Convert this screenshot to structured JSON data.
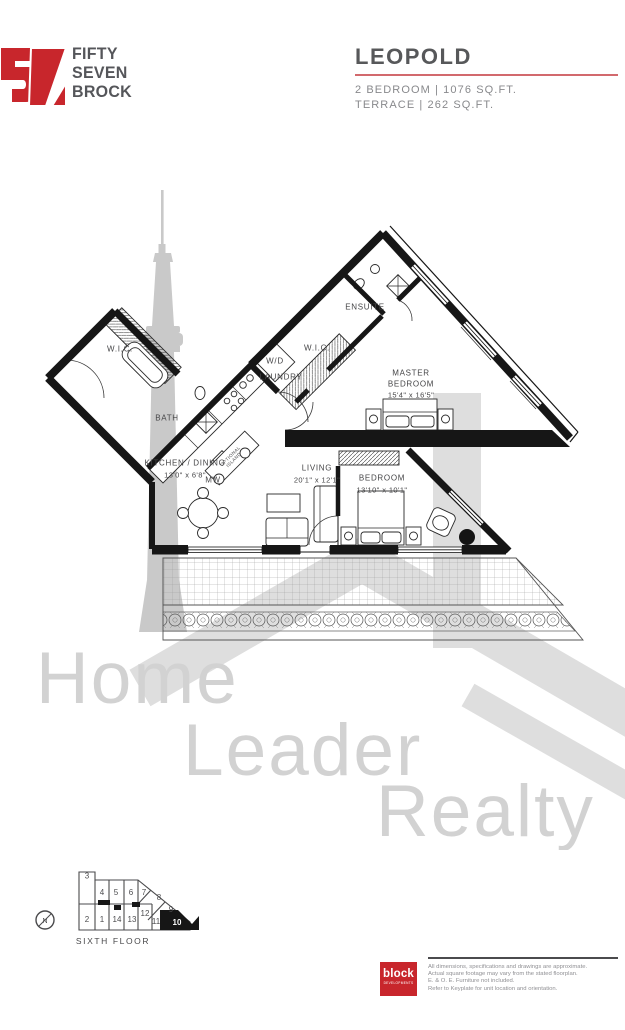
{
  "header": {
    "brand": {
      "number": "57",
      "line1": "FIFTY",
      "line2": "SEVEN",
      "line3": "BROCK"
    },
    "unit_name": "LEOPOLD",
    "spec_line1": "2 BEDROOM  |  1076 SQ.FT.",
    "spec_line2": "TERRACE  |  262 SQ.FT."
  },
  "floorplan": {
    "rooms": {
      "entry_wic": {
        "label": "W.I.C."
      },
      "bath": {
        "label": "BATH"
      },
      "ensuite": {
        "label": "ENSUITE"
      },
      "master_wic": {
        "label": "W.I.C."
      },
      "washer_dryer": {
        "label": "W/D"
      },
      "laundry": {
        "label": "LAUNDRY"
      },
      "master_bedroom": {
        "label1": "MASTER",
        "label2": "BEDROOM",
        "dims": "15'4\" x 16'5\""
      },
      "kitchen_dining": {
        "label": "KITCHEN / DINING",
        "dims": "13'0\" x 6'8\""
      },
      "living": {
        "label": "LIVING",
        "dims": "20'1\" x 12'1\""
      },
      "bedroom": {
        "label": "BEDROOM",
        "dims": "13'10\" x 10'1\""
      }
    },
    "annotations": {
      "microwave": "MW",
      "island_line1": "OPTIONAL",
      "island_line2": "ISLAND"
    }
  },
  "watermark": {
    "word1": "Home",
    "word2": "Leader",
    "word3": "Realty"
  },
  "keyplate": {
    "units": [
      "3",
      "4",
      "5",
      "6",
      "7",
      "8",
      "9",
      "2",
      "1",
      "14",
      "13",
      "12",
      "11",
      "10"
    ],
    "highlighted_unit": "10",
    "floor_label": "SIXTH FLOOR",
    "compass": "N"
  },
  "footer": {
    "developer": {
      "name": "block",
      "sub": "DEVELOPMENTS"
    },
    "disclaimer_line1": "All dimensions, specifications and drawings are approximate.",
    "disclaimer_line2": "Actual square footage may vary from the stated floorplan.",
    "disclaimer_line3": "E. & O. E. Furniture not included.",
    "disclaimer_line4": "Refer to Keyplate for unit location and orientation."
  },
  "colors": {
    "accent_red": "#c8262c",
    "underline_red": "#d2696d",
    "brand_gray": "#55565a",
    "wall_black": "#161616",
    "watermark_gray": "#d2d2d2"
  }
}
